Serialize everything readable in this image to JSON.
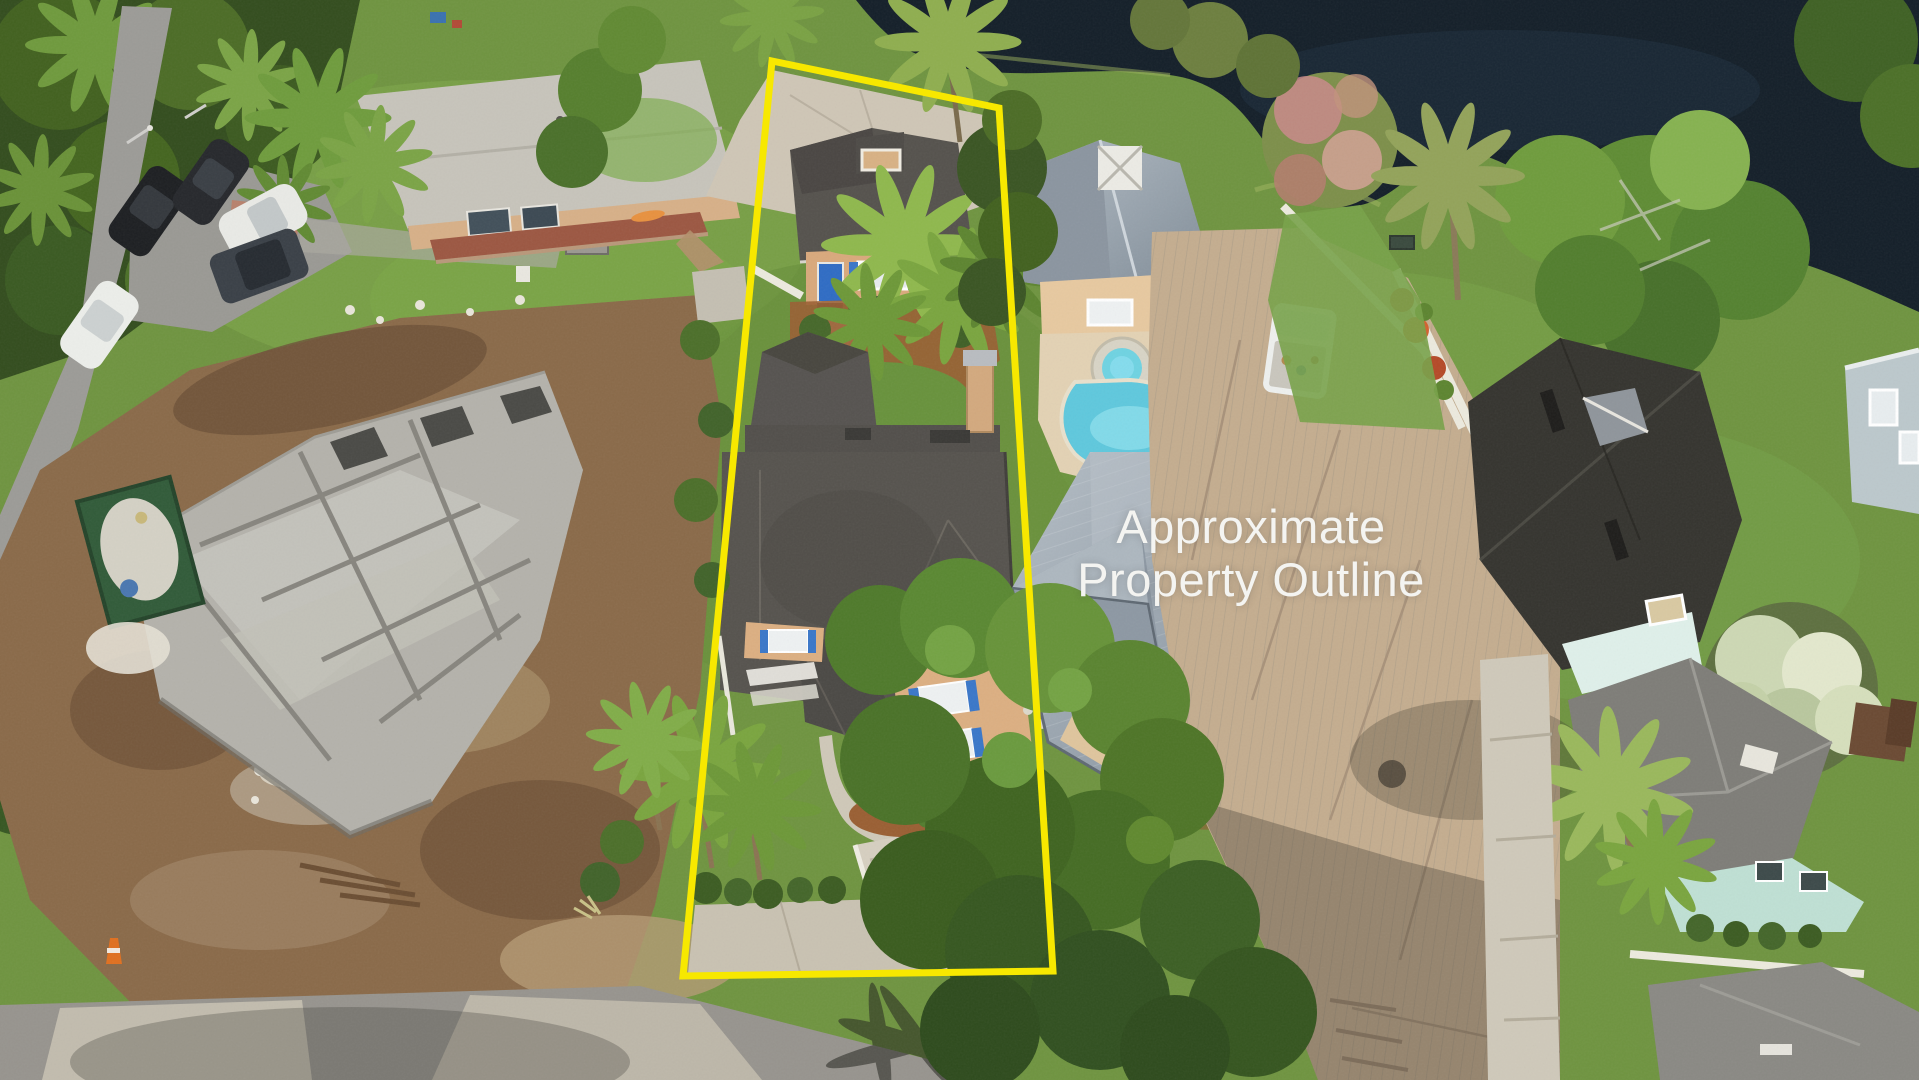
{
  "overlay": {
    "label_line1": "Approximate",
    "label_line2": "Property Outline",
    "outline_points": "772,61 999,108 1053,971 683,976",
    "outline_color": "#f7e800",
    "label_color": "#f4f4f1"
  },
  "scene": {
    "description": "Aerial drone photograph of a residential lot outlined in yellow, flanked by a construction site, neighboring homes, a pool and a pond",
    "palette": {
      "grass": "#6f9440",
      "grass_light": "#7fa84a",
      "water": "#141f29",
      "dirt": "#8a6a49",
      "asphalt": "#9c9b97",
      "concrete": "#cfc6b6",
      "neighbor_driveway": "#c4ad8f",
      "foundation_concrete": "#b4b2ab",
      "roof_dark": "#56534e",
      "roof_charcoal": "#35342f",
      "roof_light_gray": "#c7c4bb",
      "roof_metal_silver": "#98a3ad",
      "walls_tan": "#d9a97c",
      "shutters_blue": "#2f6cc4",
      "pool_water": "#5fc8dd",
      "mint_walls": "#bfe0d4",
      "fence_white": "#eceade",
      "mulch": "#9a5f33"
    },
    "features": [
      "pond",
      "construction-foundation",
      "green-dumpster",
      "parked-cars",
      "street",
      "subject-house",
      "rear-cottage",
      "front-yard-palms",
      "curved-walkway",
      "neighbor-pool",
      "neighbor-metal-roof-house",
      "white-pickup-truck",
      "white-privacy-fence",
      "concrete-driveway",
      "charcoal-roof-house",
      "mint-green-house",
      "flowering-tree",
      "bottom-road"
    ]
  }
}
